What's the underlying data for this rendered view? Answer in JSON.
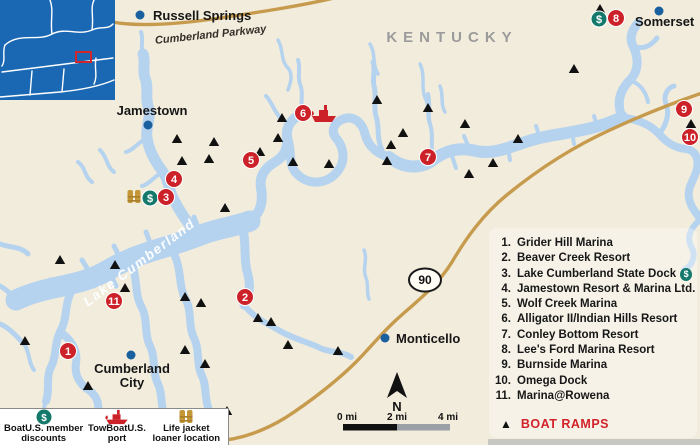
{
  "map": {
    "region_label": "KENTUCKY",
    "lake_label": "Lake Cumberland",
    "parkway_label": "Cumberland Parkway",
    "route_shield": "90",
    "cities": {
      "russell_springs": "Russell Springs",
      "jamestown": "Jamestown",
      "monticello": "Monticello",
      "cumberland_city_line1": "Cumberland",
      "cumberland_city_line2": "City",
      "somerset": "Somerset"
    },
    "markers": [
      {
        "n": "1",
        "x": 68,
        "y": 351
      },
      {
        "n": "2",
        "x": 245,
        "y": 297
      },
      {
        "n": "3",
        "x": 166,
        "y": 197
      },
      {
        "n": "4",
        "x": 174,
        "y": 179
      },
      {
        "n": "5",
        "x": 251,
        "y": 160
      },
      {
        "n": "6",
        "x": 303,
        "y": 113
      },
      {
        "n": "7",
        "x": 428,
        "y": 157
      },
      {
        "n": "8",
        "x": 616,
        "y": 18
      },
      {
        "n": "9",
        "x": 684,
        "y": 109
      },
      {
        "n": "10",
        "x": 690,
        "y": 137
      },
      {
        "n": "11",
        "x": 114,
        "y": 301
      }
    ],
    "boat_ramps": [
      [
        600,
        9
      ],
      [
        574,
        69
      ],
      [
        377,
        100
      ],
      [
        428,
        108
      ],
      [
        465,
        124
      ],
      [
        691,
        124
      ],
      [
        518,
        139
      ],
      [
        493,
        163
      ],
      [
        469,
        174
      ],
      [
        403,
        133
      ],
      [
        391,
        145
      ],
      [
        387,
        161
      ],
      [
        282,
        118
      ],
      [
        278,
        138
      ],
      [
        293,
        162
      ],
      [
        329,
        164
      ],
      [
        177,
        139
      ],
      [
        214,
        142
      ],
      [
        182,
        161
      ],
      [
        209,
        159
      ],
      [
        260,
        152
      ],
      [
        225,
        208
      ],
      [
        60,
        260
      ],
      [
        115,
        265
      ],
      [
        125,
        288
      ],
      [
        25,
        341
      ],
      [
        185,
        297
      ],
      [
        201,
        303
      ],
      [
        185,
        350
      ],
      [
        205,
        364
      ],
      [
        88,
        386
      ],
      [
        258,
        318
      ],
      [
        271,
        322
      ],
      [
        288,
        345
      ],
      [
        338,
        351
      ],
      [
        227,
        411
      ]
    ]
  },
  "legend": {
    "items": [
      {
        "num": "1.",
        "name": "Grider Hill Marina",
        "dollar": false
      },
      {
        "num": "2.",
        "name": "Beaver Creek Resort",
        "dollar": false
      },
      {
        "num": "3.",
        "name": "Lake Cumberland State Dock",
        "dollar": true
      },
      {
        "num": "4.",
        "name": "Jamestown Resort & Marina Ltd.",
        "dollar": false
      },
      {
        "num": "5.",
        "name": "Wolf Creek Marina",
        "dollar": false
      },
      {
        "num": "6.",
        "name": "Alligator II/Indian Hills Resort",
        "dollar": false
      },
      {
        "num": "7.",
        "name": "Conley Bottom Resort",
        "dollar": false
      },
      {
        "num": "8.",
        "name": "Lee's Ford Marina Resort",
        "dollar": false
      },
      {
        "num": "9.",
        "name": "Burnside Marina",
        "dollar": false
      },
      {
        "num": "10.",
        "name": "Omega Dock",
        "dollar": false
      },
      {
        "num": "11.",
        "name": "Marina@Rowena",
        "dollar": false
      }
    ],
    "boat_ramps_label": "BOAT RAMPS"
  },
  "key": {
    "items": [
      {
        "icon": "boatus-dollar-icon",
        "label": "BoatU.S. member discounts"
      },
      {
        "icon": "towboat-icon",
        "label": "TowBoatU.S. port"
      },
      {
        "icon": "life-jacket-icon",
        "label": "Life jacket loaner location"
      }
    ]
  },
  "scale": {
    "labels": [
      "0 mi",
      "2 mi",
      "4 mi"
    ],
    "north_label": "N"
  },
  "icons": {
    "dollar_symbol": "$",
    "boat_ramp_triangle": "▲"
  },
  "colors": {
    "background": "#f2ecdc",
    "lake": "#b5d3ef",
    "road": "#c79b4e",
    "marker_red": "#cc2128",
    "dollar_teal": "#14796b",
    "lifejacket_gold": "#c39738",
    "city_dot": "#1a5f9e",
    "inset_blue": "#1a68b3",
    "region_gray": "#9b9b9b",
    "boat_ramp": "#111111",
    "legend_red": "#d2232a"
  }
}
